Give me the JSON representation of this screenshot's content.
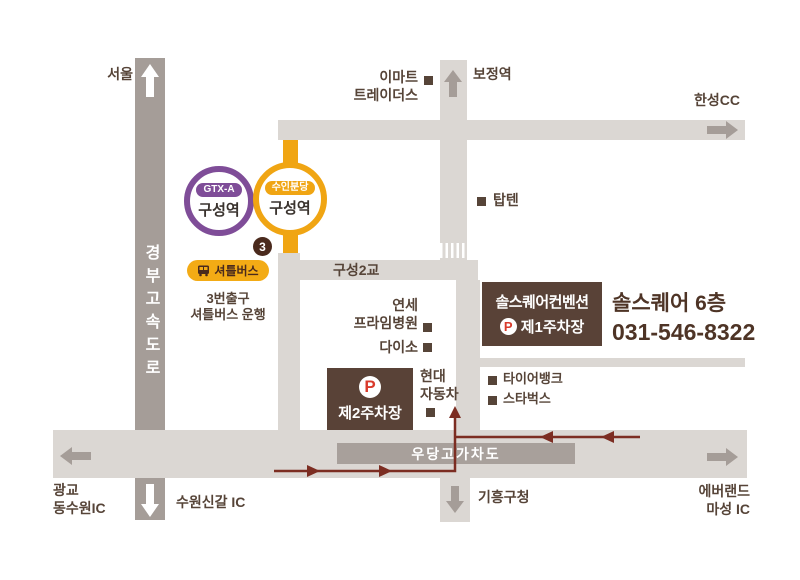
{
  "map": {
    "stations": {
      "gtx": {
        "line": "GTX-A",
        "name": "구성역"
      },
      "suin": {
        "line": "수인분당",
        "name": "구성역"
      },
      "bojeong": "보정역",
      "exit_badge": "3"
    },
    "shuttle": {
      "label": "셔틀버스",
      "note1": "3번출구",
      "note2": "셔틀버스 운행"
    },
    "venue": {
      "title": "솔스퀘어컨벤션",
      "parking1": "제1주차장",
      "parking2": "제2주차장",
      "p": "P",
      "info_line1": "솔스퀘어 6층",
      "info_line2": "031-546-8322"
    },
    "roads": {
      "expressway": "경부고속도로",
      "bridge": "구성2교",
      "overpass": "우당고가차도"
    },
    "places": {
      "emart1": "이마트",
      "emart2": "트레이더스",
      "hanseong": "한성CC",
      "topten": "탑텐",
      "yonsei1": "연세",
      "yonsei2": "프라임병원",
      "daiso": "다이소",
      "hyundai1": "현대",
      "hyundai2": "자동차",
      "tirebank": "타이어뱅크",
      "starbucks": "스타벅스"
    },
    "directions": {
      "seoul": "서울",
      "gwanggyo1": "광교",
      "gwanggyo2": "동수원IC",
      "suwon_singal": "수원신갈 IC",
      "giheung": "기흥구청",
      "everland1": "에버랜드",
      "everland2": "마성 IC"
    },
    "colors": {
      "road_light": "#dbd7d3",
      "road_dark": "#a59d98",
      "brown": "#594237",
      "yellow": "#f0a513",
      "purple": "#7f4d98",
      "route": "#7c2d22",
      "red_p": "#d93a2b",
      "label_text": "#564438"
    }
  }
}
